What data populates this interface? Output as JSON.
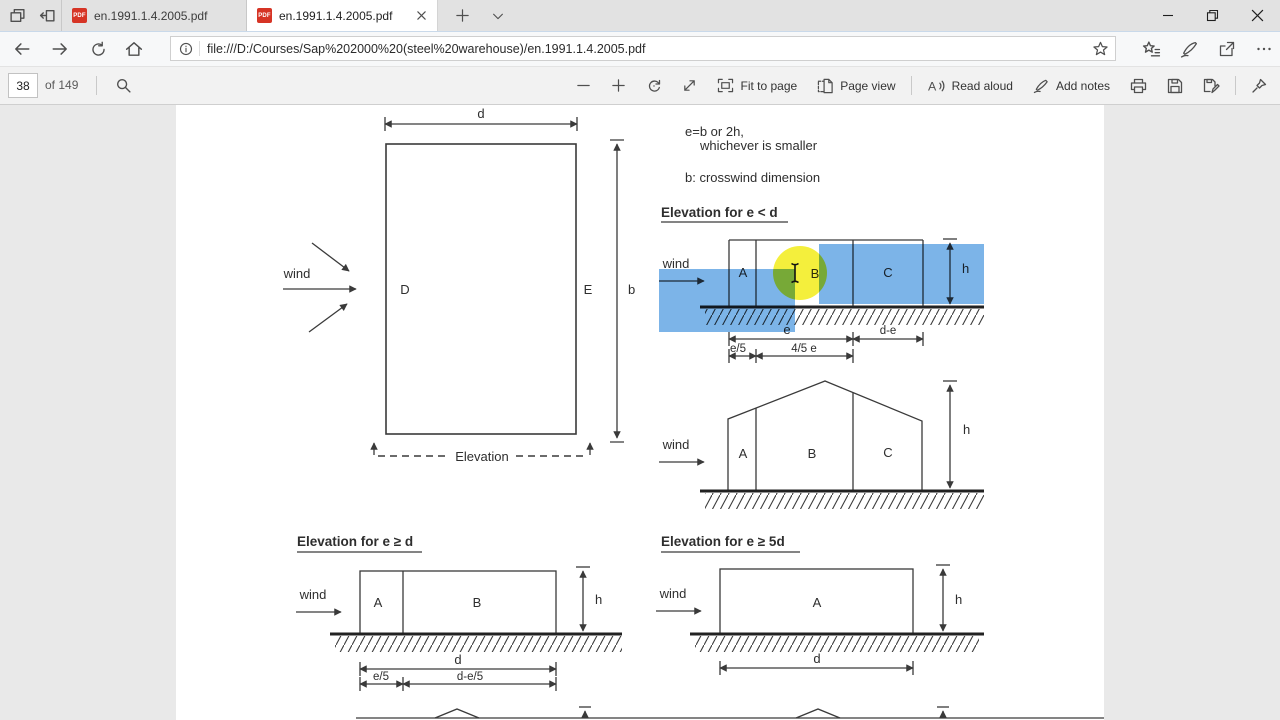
{
  "tabs": {
    "tab1": {
      "title": "en.1991.1.4.2005.pdf",
      "icon_label": "PDF"
    },
    "tab2": {
      "title": "en.1991.1.4.2005.pdf",
      "icon_label": "PDF"
    }
  },
  "nav": {
    "url": "file:///D:/Courses/Sap%202000%20(steel%20warehouse)/en.1991.1.4.2005.pdf"
  },
  "toolbar": {
    "page_number": "38",
    "page_total": "of 149",
    "fit_to_page": "Fit to page",
    "page_view": "Page view",
    "read_aloud": "Read aloud",
    "read_aloud_glyph": "A",
    "add_notes": "Add notes"
  },
  "doc": {
    "note_line1": "e=b or 2h,",
    "note_line2": "whichever is smaller",
    "note_line3": "b: crosswind dimension",
    "h1": "Elevation for e < d",
    "h2": "Elevation for e ≥ d",
    "h3": "Elevation for e ≥ 5d",
    "plan": {
      "d": "d",
      "b": "b",
      "D": "D",
      "E": "E",
      "wind": "wind",
      "elevation": "Elevation"
    },
    "e1": {
      "wind": "wind",
      "A": "A",
      "B": "B",
      "C": "C",
      "h": "h",
      "e": "e",
      "de": "d-e",
      "e5": "e/5",
      "e45": "4/5 e"
    },
    "e2": {
      "wind": "wind",
      "A": "A",
      "B": "B",
      "C": "C",
      "h": "h"
    },
    "e3": {
      "wind": "wind",
      "A": "A",
      "B": "B",
      "h": "h",
      "d": "d",
      "e5": "e/5",
      "de5": "d-e/5"
    },
    "e4": {
      "wind": "wind",
      "A": "A",
      "h": "h",
      "d": "d"
    }
  },
  "colors": {
    "selection_blue": "#7cb4e8",
    "cursor_highlight": "#f4ef3c",
    "pdf_red": "#d63425"
  }
}
